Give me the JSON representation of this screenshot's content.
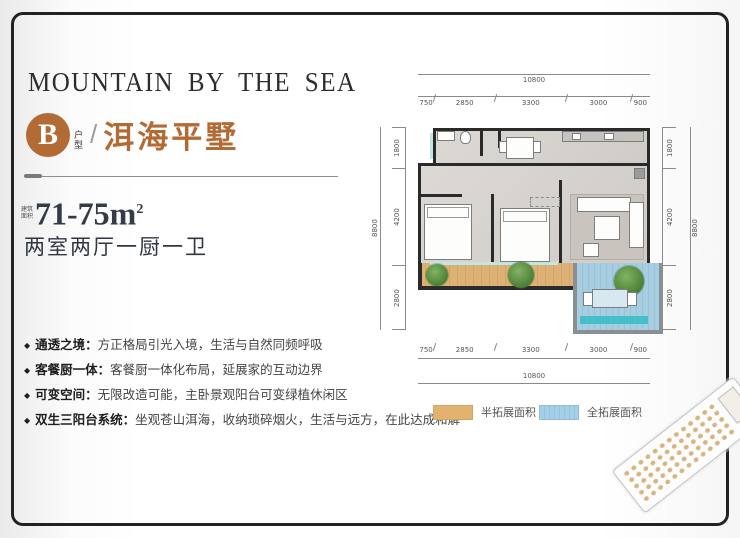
{
  "brand": {
    "logo": "MOUNTAIN BY THE SEA"
  },
  "unit": {
    "badge_letter": "B",
    "badge_caption": "户型",
    "separator": "/",
    "name": "洱海平墅",
    "area_prefix": "建筑面积",
    "area_value": "71-75",
    "area_unit": "m",
    "area_sup": "2",
    "layout": "两室两厅一厨一卫"
  },
  "ui": {
    "bullet": "◆"
  },
  "features": [
    {
      "label": "通透之境：",
      "text": "方正格局引光入境，生活与自然同频呼吸"
    },
    {
      "label": "客餐厨一体：",
      "text": "客餐厨一体化布局，延展家的互动边界"
    },
    {
      "label": "可变空间：",
      "text": "无限改造可能，主卧景观阳台可变绿植休闲区"
    },
    {
      "label": "双生三阳台系统：",
      "text": "坐观苍山洱海，收纳琐碎烟火，生活与远方，在此达成和解"
    }
  ],
  "plan": {
    "dims_top_total": "10800",
    "dims_top": [
      "750",
      "2850",
      "3300",
      "3000",
      "900"
    ],
    "dims_bottom": [
      "750",
      "2850",
      "3300",
      "3000",
      "900"
    ],
    "dims_bottom_total": "10800",
    "dims_left": [
      "1800",
      "4200",
      "2800"
    ],
    "dims_left_total": "8800",
    "dims_right": [
      "1800",
      "4200",
      "2800"
    ],
    "dims_right_total": "8800"
  },
  "legend": [
    {
      "swatch": "#e2b36e",
      "label": "半拓展面积"
    },
    {
      "swatch": "#a5cfe6",
      "label": "全拓展面积"
    }
  ],
  "colors": {
    "accent": "#b26b35",
    "dark_text": "#333b46",
    "wall": "#2a2a2a",
    "floor": "#d6d2ce",
    "deck_tan": "#dcb173",
    "terrace_blue": "#9fcade",
    "teal_strip": "#45bec8",
    "tree_green": "#5d9448"
  }
}
